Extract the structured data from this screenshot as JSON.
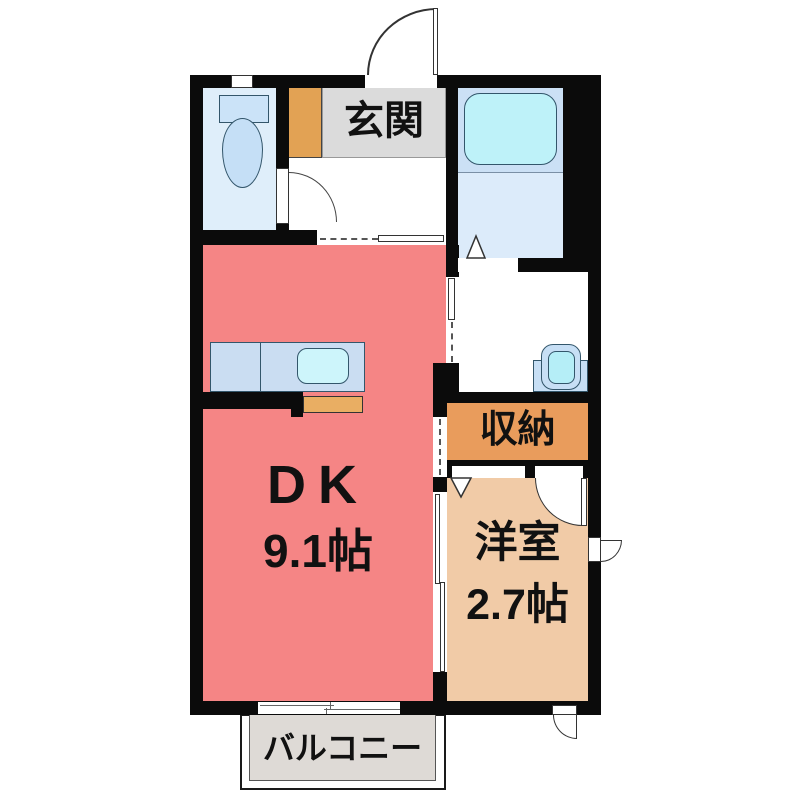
{
  "floorplan": {
    "rooms": {
      "genkan": {
        "label": "玄関"
      },
      "dk": {
        "label": "DK",
        "size": "9.1帖"
      },
      "youshitsu": {
        "label": "洋室",
        "size": "2.7帖"
      },
      "shuunou": {
        "label": "収納"
      },
      "balcony": {
        "label": "バルコニー"
      }
    },
    "colors": {
      "wall": "#0b0b0b",
      "dk": "#F58585",
      "youshitsu": "#F1CBA7",
      "shuunou": "#E99C5C",
      "shoe_cabinet": "#E2A254",
      "genkan_floor": "#DBDBDB",
      "balcony_floor": "#DEDAD6",
      "toilet_floor": "#DFEEFA",
      "bath_upper": "#CBE0F5",
      "bath_lower": "#DCEBFA",
      "bathtub": "#BEF2F9",
      "counter": "#CADDF2",
      "sink": "#CDF5FB",
      "cabinet": "#E9AE63",
      "vanity": "#C7DFF5",
      "vanity_bowl": "#B5EEF7",
      "fixture_blue": "#C5DFF6",
      "fixture_tank": "#CBE3F8"
    }
  }
}
